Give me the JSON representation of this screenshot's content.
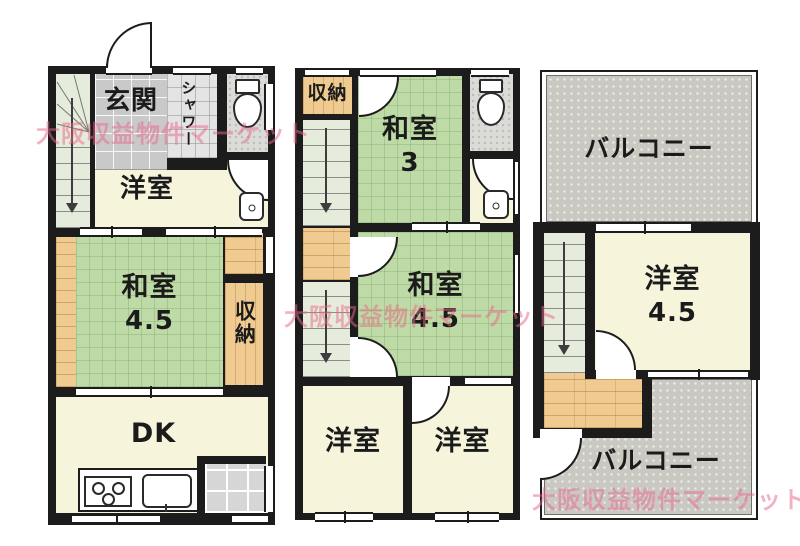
{
  "watermark": {
    "text": "大阪収益物件マーケット",
    "color": "#e8688a"
  },
  "floor1": {
    "genkan": "玄関",
    "shower": "シャワー",
    "yoshitsu": "洋室",
    "washitsu": "和室",
    "washitsu_num": "4.5",
    "shunou": "収納",
    "dk": "DK"
  },
  "floor2": {
    "shunou": "収納",
    "washitsu3": "和室",
    "washitsu3_num": "3",
    "washitsu45": "和室",
    "washitsu45_num": "4.5",
    "yoshitsuL": "洋室",
    "yoshitsuR": "洋室"
  },
  "floor3": {
    "balcony_top": "バルコニー",
    "yoshitsu": "洋室",
    "yoshitsu_num": "4.5",
    "balcony_bottom": "バルコニー"
  },
  "colors": {
    "wall": "#1c1c1c",
    "tatami": "#bedaa6",
    "wood": "#efcb92",
    "room_cream": "#f7f4dc",
    "balcony_gray": "#c9c9c1",
    "stairs_green": "#e6ecdc",
    "watermark_pink": "#e8688a"
  }
}
